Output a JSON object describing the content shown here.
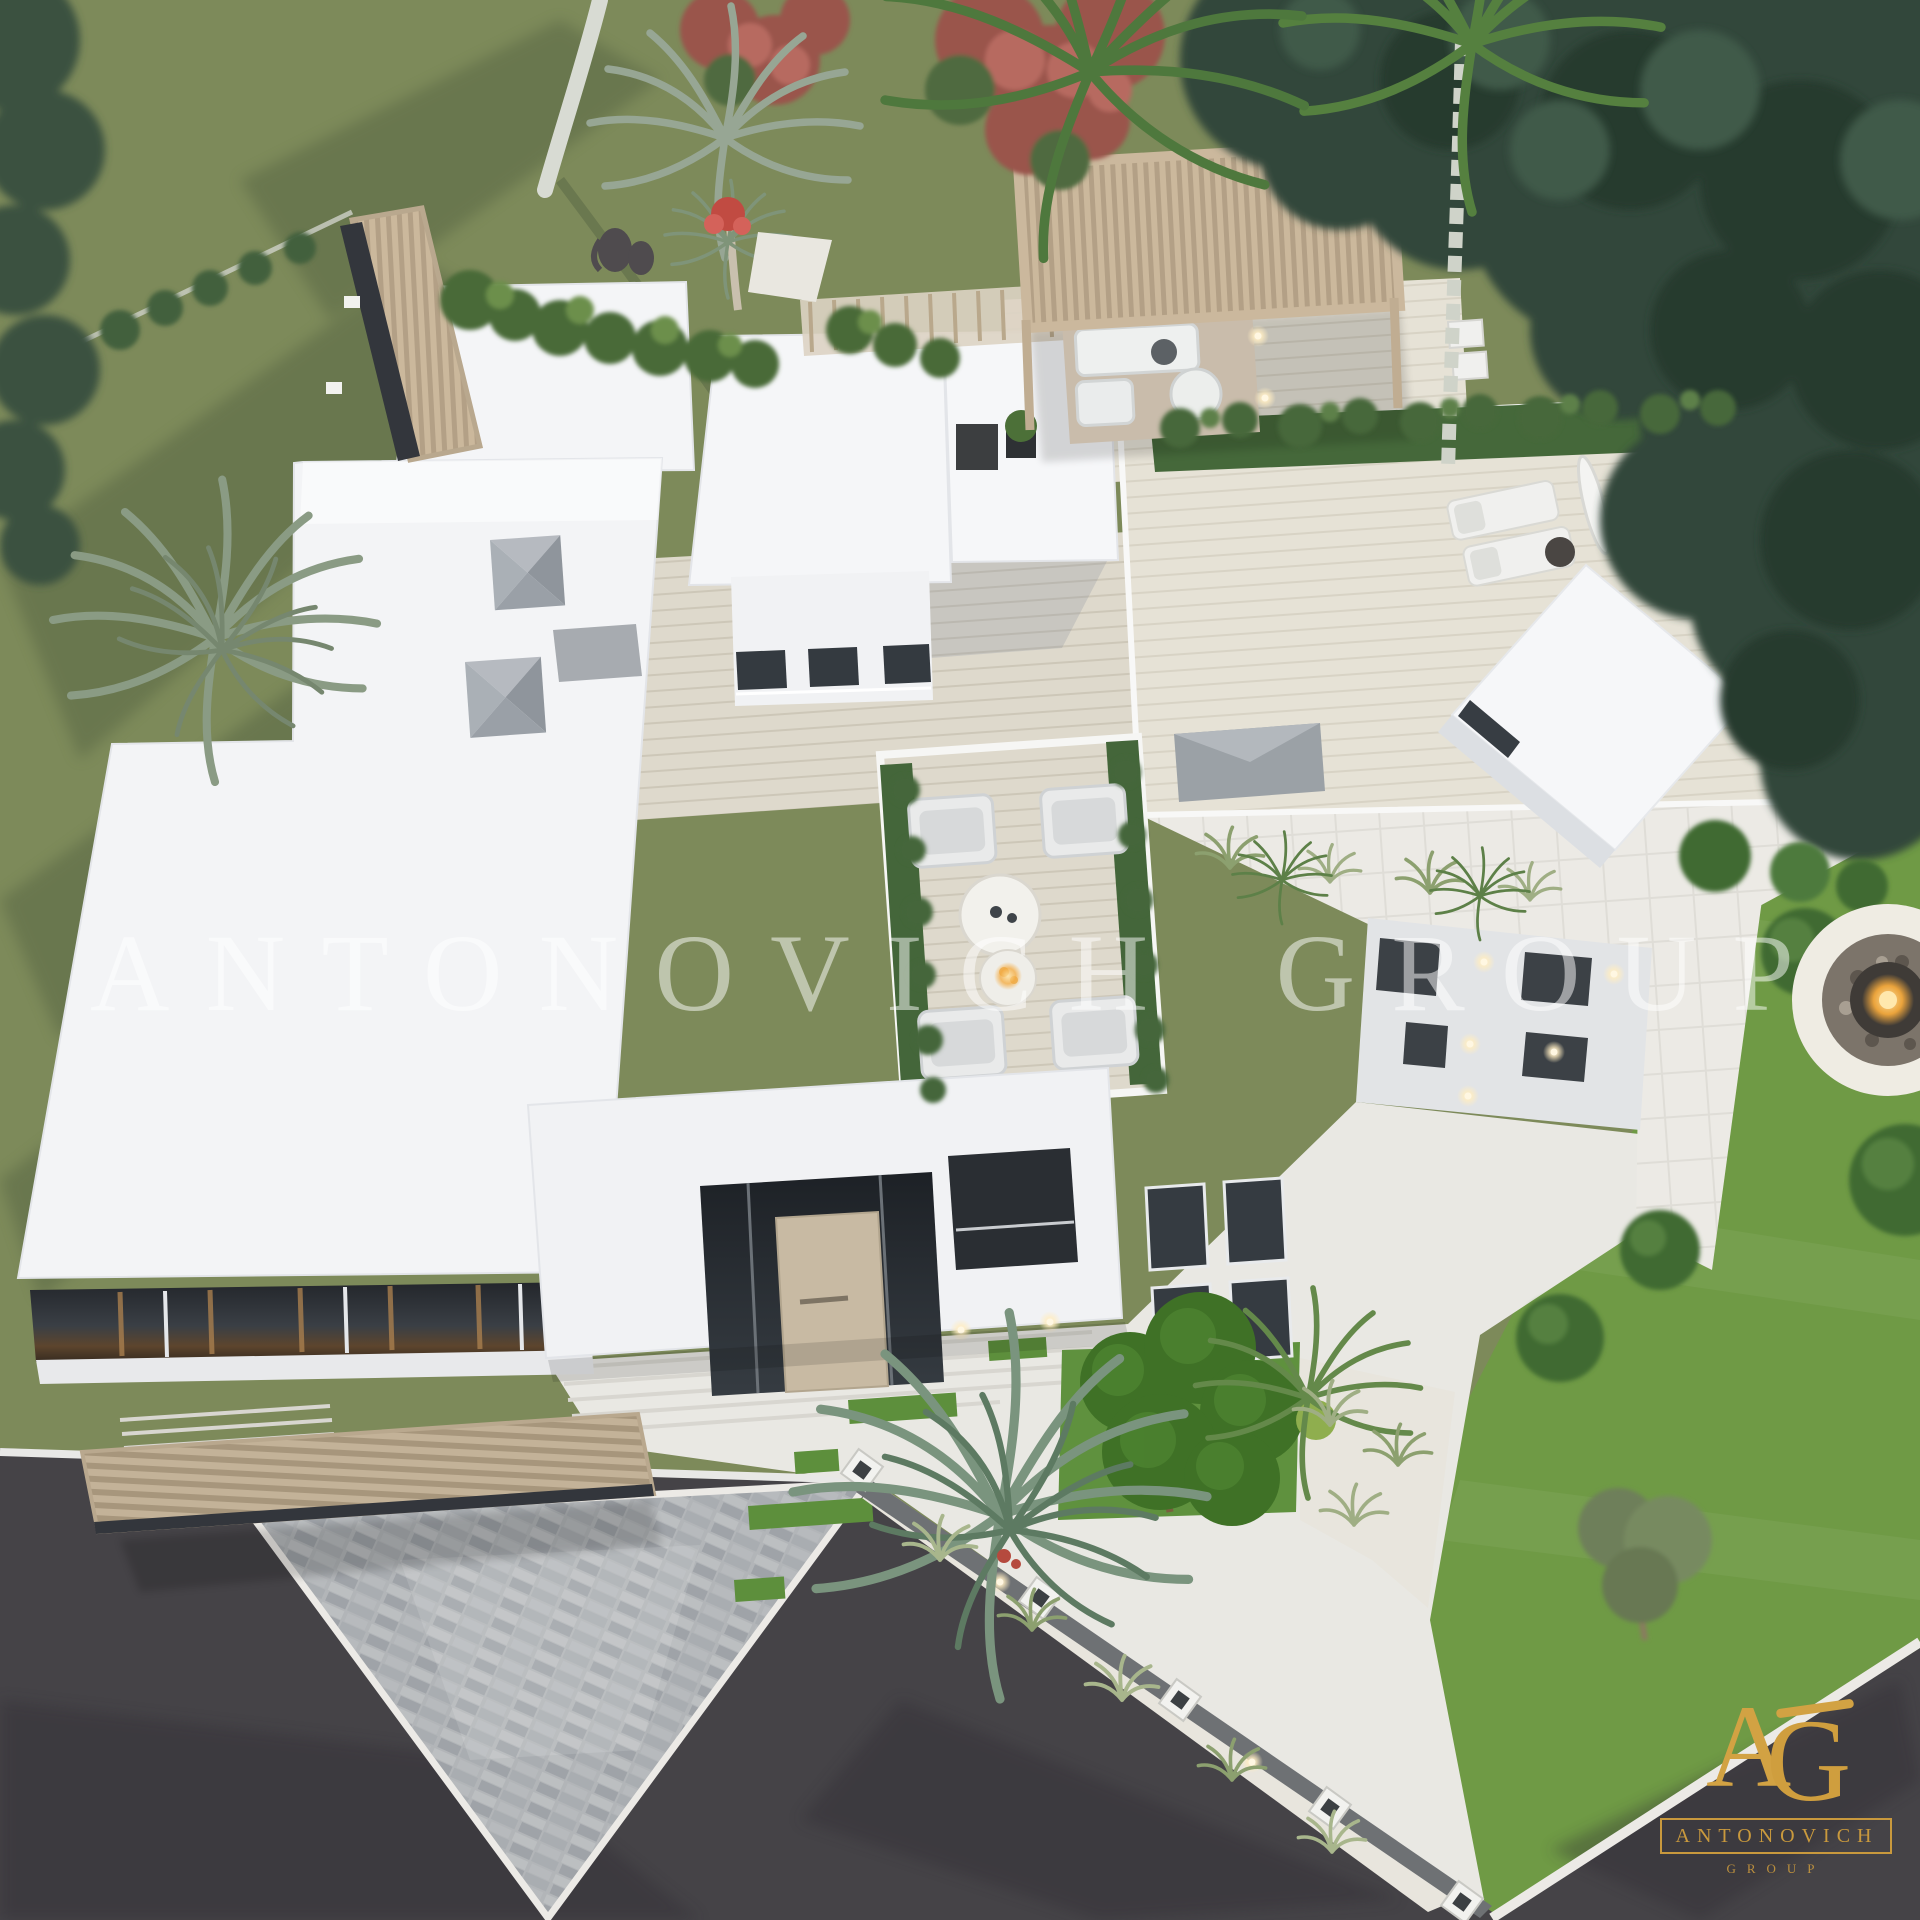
{
  "image": {
    "description": "Aerial top-down 3D architectural rendering of a modern flat-roofed white luxury villa with rooftop terraces, wooden pergolas, landscaped garden, paver driveway and surrounding streets",
    "style": "photorealistic CGI exterior visualization"
  },
  "watermark": {
    "text": "ANTONOVICH GROUP"
  },
  "logo": {
    "monogram_a": "A",
    "monogram_g": "G",
    "name": "ANTONOVICH",
    "subtitle": "GROUP",
    "color": "#c9993d"
  },
  "colors": {
    "lawn": "#7d8a5a",
    "lawn_bright": "#6f9a45",
    "tree_canopy": "#31473a",
    "asphalt": "#454347",
    "paver": "#b2b5b8",
    "walkway": "#e9e8e3",
    "roof_white": "#f4f5f7",
    "travertine": "#ded9cc",
    "pergola_wood": "#c6b49b",
    "skylight_gray": "#9ba1a6",
    "window_dark": "#343a40",
    "door_beige": "#c8baa3",
    "topiary_green": "#3f7126",
    "fire_glow": "#f4a93c"
  },
  "scene": {
    "elements": [
      "white-flat-roofs",
      "pyramid-skylights",
      "clerestory-windows",
      "rooftop-lounge-terrace",
      "wood-pergola-lounge",
      "louvered-entrance-canopy",
      "glass-entry-door",
      "wall-sconces",
      "sun-loungers",
      "closed-umbrella",
      "planter-hedges",
      "statue",
      "palm-trees",
      "red-flowering-trees",
      "dense-tree-canopy",
      "front-walkway-with-grass-inlays",
      "topiary-ball-trees",
      "grass-patch",
      "gravel-beds-with-grasses",
      "boundary-wall-with-posts",
      "stone-paver-driveway",
      "asphalt-street",
      "fire-pit",
      "lawn"
    ]
  }
}
